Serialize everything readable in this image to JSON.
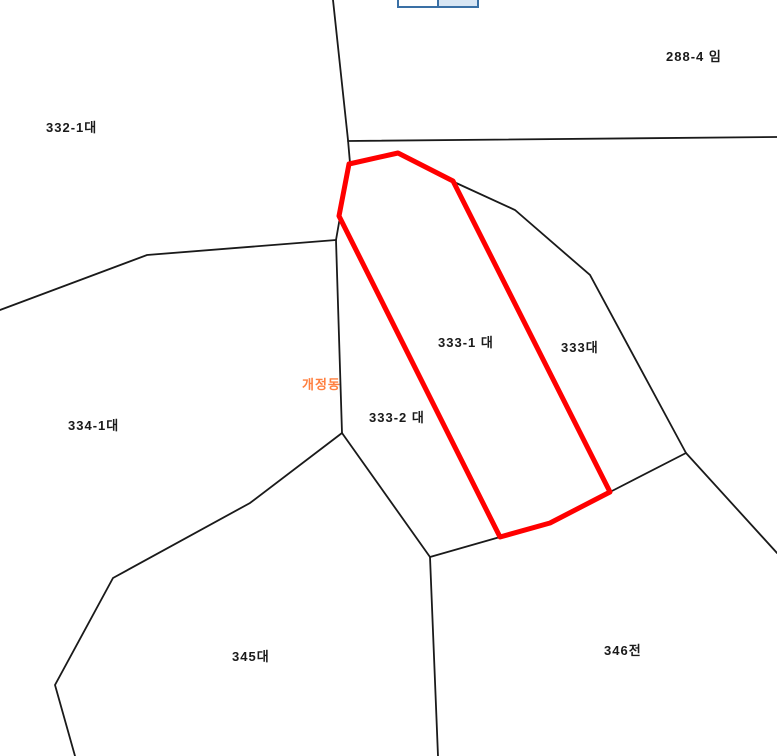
{
  "ui": {
    "toolbar_buttons": {
      "count": 2,
      "border_color": "#3a70a5",
      "right_button_fill": "#d8e6f4"
    }
  },
  "map": {
    "background_color": "#ffffff",
    "boundary_color": "#1a1a1a",
    "highlight_color": "#ff0000",
    "district_label": {
      "text": "개정동",
      "color": "#ff8040"
    },
    "parcels": {
      "p332_1": {
        "label": "332-1대"
      },
      "p288_4": {
        "label": "288-4 임"
      },
      "p333_1": {
        "label": "333-1 대",
        "highlighted": true
      },
      "p333": {
        "label": "333대"
      },
      "p333_2": {
        "label": "333-2 대"
      },
      "p334_1": {
        "label": "334-1대"
      },
      "p345": {
        "label": "345대"
      },
      "p346": {
        "label": "346전"
      }
    }
  }
}
